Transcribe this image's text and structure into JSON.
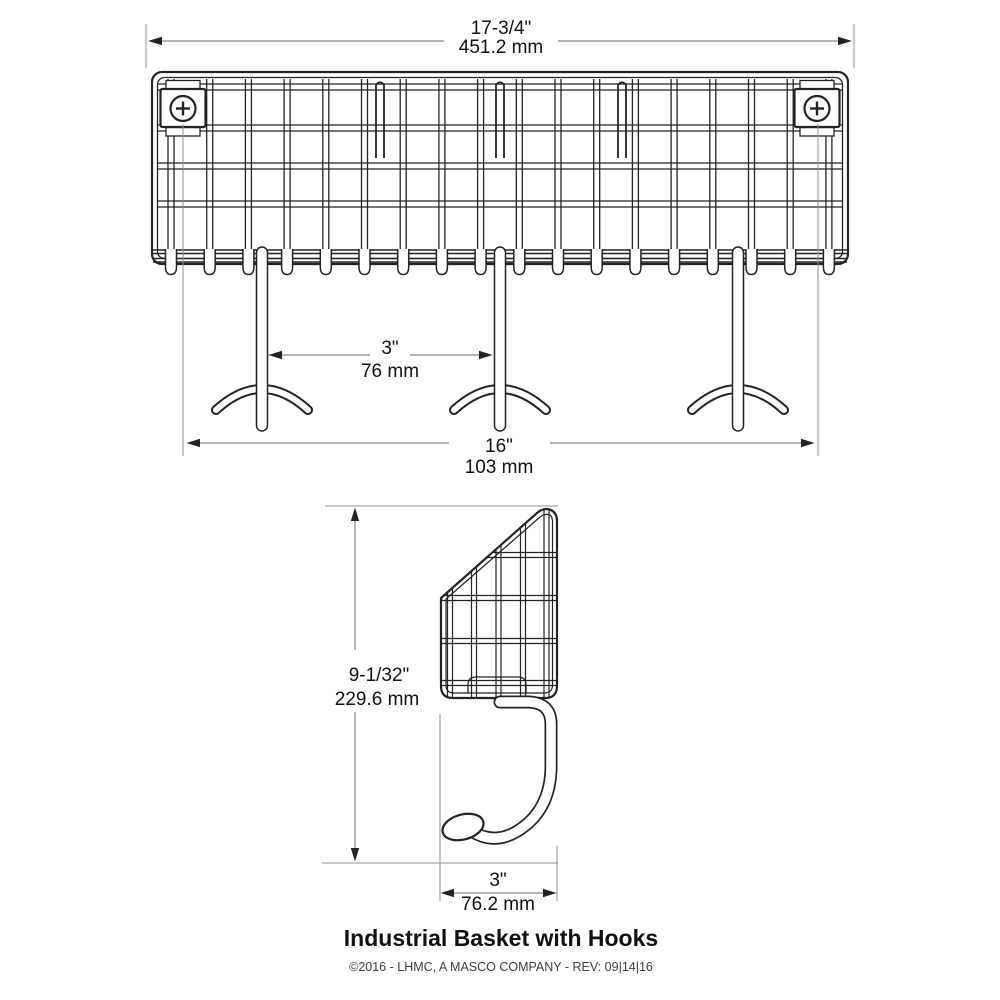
{
  "title": "Industrial Basket with Hooks",
  "footer": "©2016 - LHMC, A MASCO COMPANY - REV: 09|14|16",
  "dimensions": {
    "overall_width": {
      "inches": "17-3/4\"",
      "mm": "451.2 mm"
    },
    "hook_spacing": {
      "inches": "3\"",
      "mm": "76 mm"
    },
    "mount_spacing": {
      "inches": "16\"",
      "mm": "103 mm"
    },
    "overall_height": {
      "inches": "9-1/32\"",
      "mm": "229.6 mm"
    },
    "hook_depth": {
      "inches": "3\"",
      "mm": "76.2 mm"
    }
  },
  "colors": {
    "background": "#ffffff",
    "line": "#232323",
    "dim_line": "#6b6b6b",
    "ext_line": "#8f8f8f",
    "text": "#111111",
    "footer_text": "#3d3d3d"
  }
}
